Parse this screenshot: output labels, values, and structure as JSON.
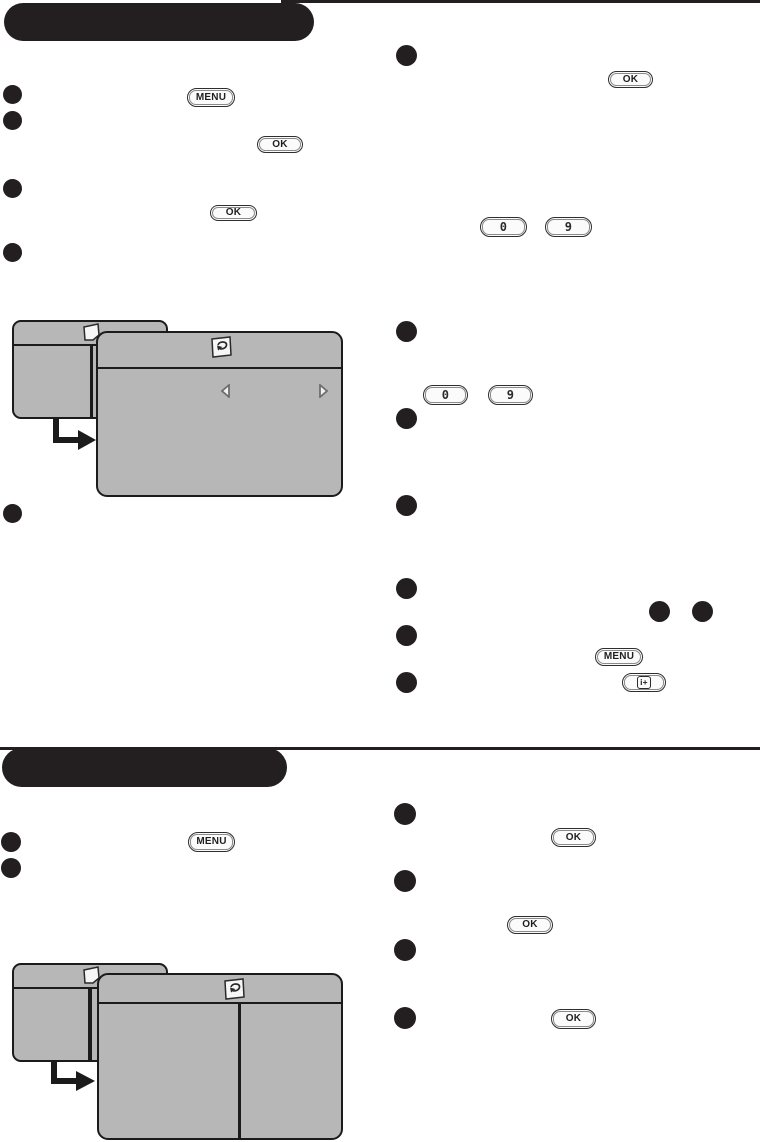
{
  "page": {
    "width": 760,
    "height": 1142,
    "background": "#ffffff"
  },
  "colors": {
    "ink": "#231f20",
    "panel_gray": "#b7b7b7",
    "panel_line": "#1b1b1b",
    "button_face": "#fbfbfb",
    "button_border": "#2e2e2e"
  },
  "remote_buttons": {
    "menu": "MENU",
    "ok": "OK",
    "digit_zero": "0",
    "digit_nine": "9",
    "info": "i+"
  },
  "sections": [
    {
      "name": "section-1",
      "header_text": "",
      "left_bullet_count": 5,
      "right_bullet_count": 7,
      "inline_bullet_pair_count": 2
    },
    {
      "name": "section-2",
      "header_text": "",
      "left_bullet_count": 2,
      "right_bullet_count": 4
    }
  ],
  "menu_mockups": [
    {
      "panels": 2,
      "back_icon": "install-icon",
      "front_icon": "install-icon",
      "nav_arrows": [
        "left-arrow-icon",
        "right-arrow-icon"
      ],
      "flow": "flow-arrow-icon"
    },
    {
      "panels": 2,
      "back_icon": "install-icon",
      "front_icon": "install-icon",
      "front_divider": true,
      "flow": "flow-arrow-icon"
    }
  ]
}
